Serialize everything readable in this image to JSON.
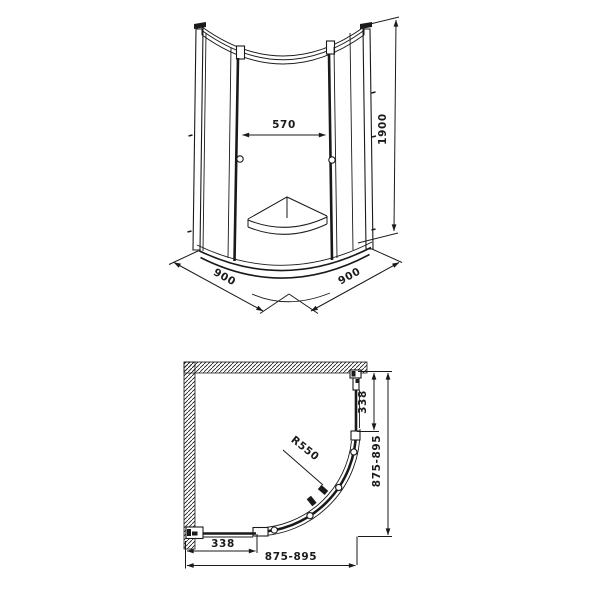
{
  "page": {
    "background": "#ffffff",
    "line_color": "#1a1a1a",
    "description": "Technical drawing of a quadrant shower enclosure: front elevation and plan view with dimensions"
  },
  "front_view": {
    "dim_opening": "570",
    "dim_height": "1900",
    "dim_side_left": "900",
    "dim_side_right": "900"
  },
  "plan_view": {
    "dim_straight_right": "338",
    "dim_depth": "875-895",
    "dim_radius": "R550",
    "dim_straight_bottom": "338",
    "dim_width": "875-895"
  }
}
